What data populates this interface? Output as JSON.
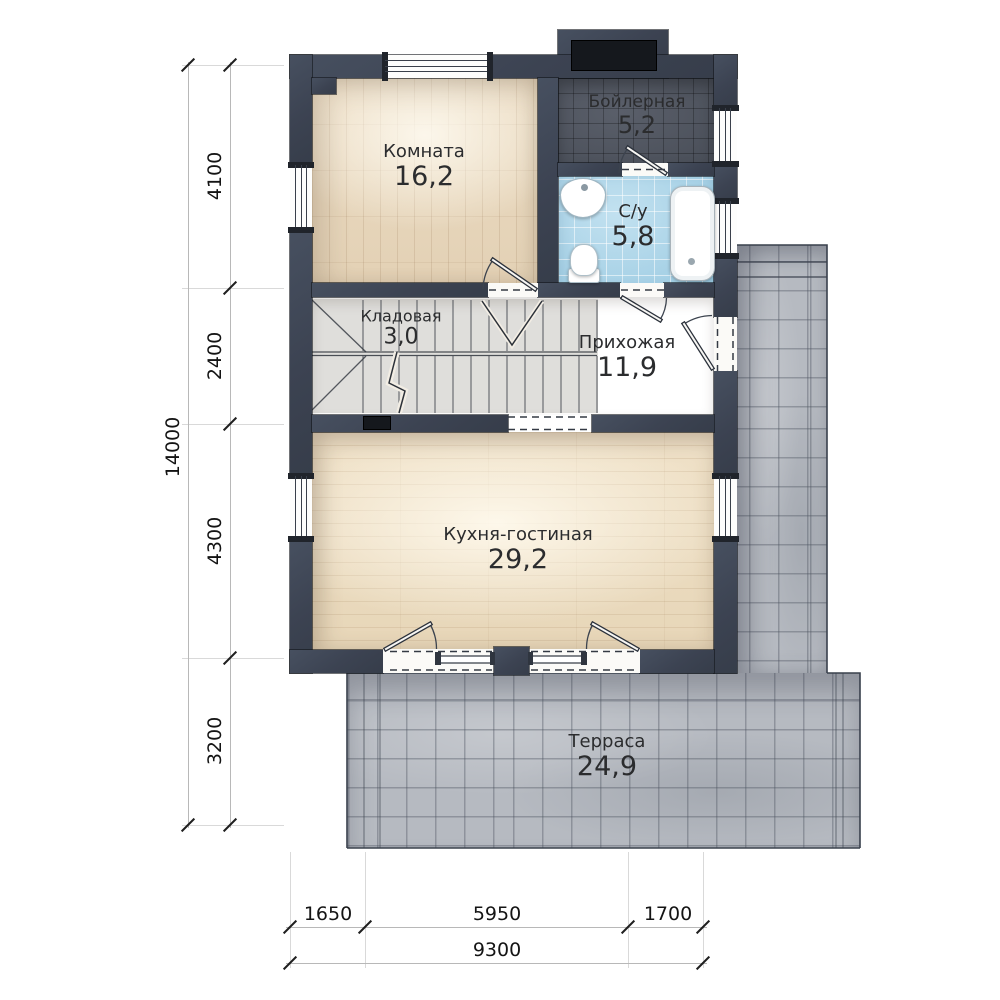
{
  "rooms": [
    {
      "name": "Комната",
      "area": "16,2"
    },
    {
      "name": "Бойлерная",
      "area": "5,2"
    },
    {
      "name": "С/у",
      "area": "5,8"
    },
    {
      "name": "Кладовая",
      "area": "3,0"
    },
    {
      "name": "Прихожая",
      "area": "11,9"
    },
    {
      "name": "Кухня-гостиная",
      "area": "29,2"
    },
    {
      "name": "Терраса",
      "area": "24,9"
    }
  ],
  "dims": {
    "left_segments": [
      "4100",
      "2400",
      "4300",
      "3200"
    ],
    "left_total": "14000",
    "bottom_segments": [
      "1650",
      "5950",
      "1700"
    ],
    "bottom_total": "9300"
  },
  "colors": {
    "wall": "#3e4552",
    "room_floor": "#ecdcc3",
    "kitchen_floor": "#f0e2c9",
    "hall_floor": "#b3a593",
    "boiler_floor": "#4d525b",
    "bath_floor": "#a9d6ea",
    "terrace": "#b6bac1",
    "dim_text": "#141414"
  }
}
